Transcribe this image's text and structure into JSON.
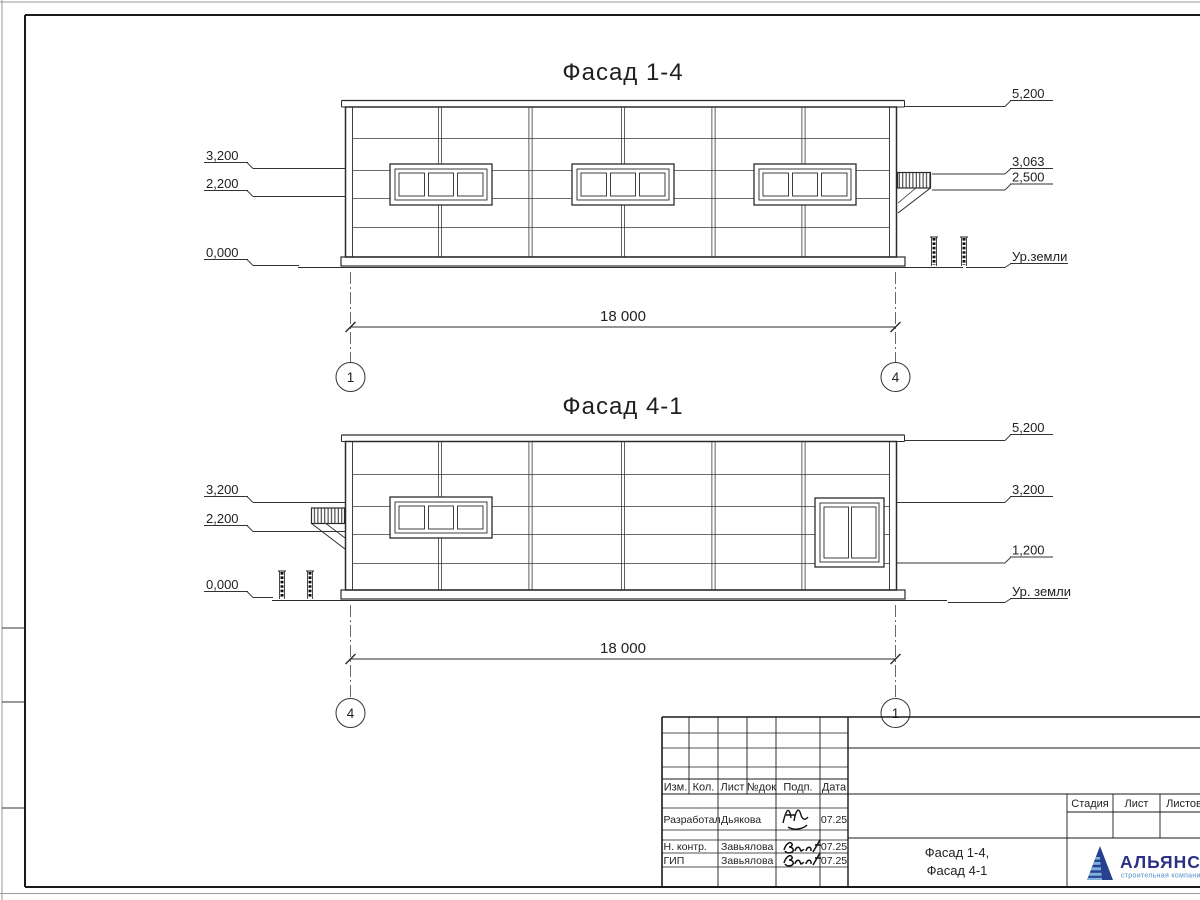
{
  "colors": {
    "ink": "#222222",
    "frame": "#1a1a1a",
    "logo_navy": "#2b3086",
    "logo_blue": "#4e8fcb"
  },
  "facade_top": {
    "title": "Фасад 1-4",
    "dim": "18 000",
    "axis_left": "1",
    "axis_right": "4",
    "mark_left_1": "3,200",
    "mark_left_2": "2,200",
    "mark_left_3": "0,000",
    "mark_right_1": "5,200",
    "mark_right_2": "3,063",
    "mark_right_3": "2,500",
    "ground": "Ур.земли"
  },
  "facade_bottom": {
    "title": "Фасад 4-1",
    "dim": "18 000",
    "axis_left": "4",
    "axis_right": "1",
    "mark_left_1": "3,200",
    "mark_left_2": "2,200",
    "mark_left_3": "0,000",
    "mark_right_1": "5,200",
    "mark_right_2": "3,200",
    "mark_right_3": "1,200",
    "ground": "Ур. земли"
  },
  "title_block": {
    "col_izm": "Изм.",
    "col_kol": "Кол.",
    "col_list": "Лист",
    "col_ndok": "№док",
    "col_podp": "Подп.",
    "col_data": "Дата",
    "row1_role": "Разработал",
    "row1_name": "Дьякова",
    "row1_date": "07.25",
    "row2_role": "Н. контр.",
    "row2_name": "Завьялова",
    "row2_date": "07.25",
    "row3_role": "ГИП",
    "row3_name": "Завьялова",
    "row3_date": "07.25",
    "stage": "Стадия",
    "sheet": "Лист",
    "sheets": "Листов",
    "doc_name_1": "Фасад 1-4,",
    "doc_name_2": "Фасад 4-1",
    "brand": "АЛЬЯНС",
    "brand_sub": "строительная компания"
  }
}
